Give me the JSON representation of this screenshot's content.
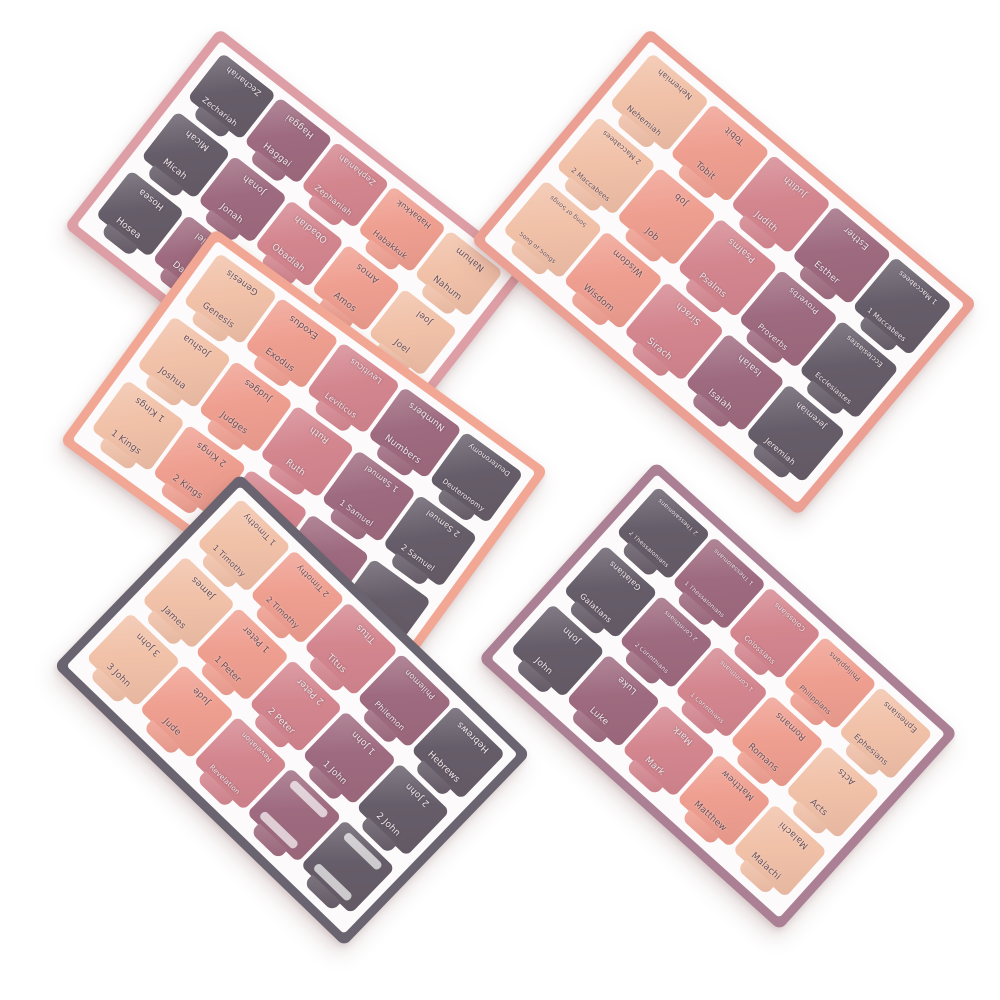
{
  "image_type": "product-photo",
  "subject": "Five sheets of Bible book index tab stickers scattered on a white background",
  "palette": {
    "page_bg": "#ffffff",
    "sheet_inner": "#fcfafa",
    "column_colors": [
      "#f1c1a8",
      "#ef9f90",
      "#d4868f",
      "#9e6a7f",
      "#655d69"
    ],
    "text_dark": "#6a4f57",
    "text_light": "#efe6ea"
  },
  "sheets": [
    {
      "id": "prophets",
      "border_color": "#dd9ea5",
      "geom": {
        "cx": 296,
        "cy": 248,
        "w": 392,
        "h": 252,
        "rot": 38,
        "z": 1
      },
      "column_color_order": [
        4,
        3,
        2,
        1,
        0
      ],
      "rows": [
        [
          "Zechariah",
          "Haggai",
          "Zephaniah",
          "Habakkuk",
          "Nahum"
        ],
        [
          "Micah",
          "Jonah",
          "Obadiah",
          "Amos",
          "Joel"
        ],
        [
          "Hosea",
          "Daniel",
          "",
          "",
          ""
        ]
      ],
      "blank_cells": []
    },
    {
      "id": "wisdom-books",
      "border_color": "#eba093",
      "geom": {
        "cx": 724,
        "cy": 272,
        "w": 428,
        "h": 278,
        "rot": 40,
        "z": 2
      },
      "column_color_order": [
        0,
        1,
        2,
        3,
        4
      ],
      "rows": [
        [
          "Nehemiah",
          "Tobit",
          "Judith",
          "Esther",
          "1 Maccabees"
        ],
        [
          "2 Maccabees",
          "Job",
          "Psalms",
          "Proverbs",
          "Ecclesiastes"
        ],
        [
          "Song of Songs",
          "Wisdom",
          "Sirach",
          "Isaiah",
          "Jeremiah"
        ]
      ],
      "blank_cells": []
    },
    {
      "id": "pentateuch-history",
      "border_color": "#f2a795",
      "geom": {
        "cx": 304,
        "cy": 456,
        "w": 412,
        "h": 264,
        "rot": 36,
        "z": 3
      },
      "column_color_order": [
        0,
        1,
        2,
        3,
        4
      ],
      "rows": [
        [
          "Genesis",
          "Exodus",
          "Leviticus",
          "Numbers",
          "Deuteronomy"
        ],
        [
          "Joshua",
          "Judges",
          "Ruth",
          "1 Samuel",
          "2 Samuel"
        ],
        [
          "1 Kings",
          "2 Kings",
          "",
          "",
          ""
        ]
      ],
      "blank_cells": []
    },
    {
      "id": "epistles-2",
      "border_color": "#6a6470",
      "geom": {
        "cx": 292,
        "cy": 710,
        "w": 404,
        "h": 268,
        "rot": 44,
        "z": 4
      },
      "column_color_order": [
        0,
        1,
        2,
        3,
        4
      ],
      "rows": [
        [
          "1 Timothy",
          "2 Timothy",
          "Titus",
          "Philemon",
          "Hebrews"
        ],
        [
          "James",
          "1 Peter",
          "2 Peter",
          "1 John",
          "2 John"
        ],
        [
          "3 John",
          "Jude",
          "Revelation",
          "",
          ""
        ]
      ],
      "blank_cells": [
        [
          2,
          3
        ],
        [
          2,
          4
        ]
      ]
    },
    {
      "id": "gospels-epistles-1",
      "border_color": "#ab8095",
      "geom": {
        "cx": 718,
        "cy": 696,
        "w": 406,
        "h": 266,
        "rot": 42,
        "z": 2
      },
      "column_color_order": [
        4,
        3,
        2,
        1,
        0
      ],
      "rows": [
        [
          "2 Thessalonians",
          "1 Thessalonians",
          "Colossians",
          "Philippians",
          "Ephesians"
        ],
        [
          "Galatians",
          "2 Corinthians",
          "1 Corinthians",
          "Romans",
          "Acts"
        ],
        [
          "John",
          "Luke",
          "Mark",
          "Matthew",
          "Malachi"
        ]
      ],
      "blank_cells": []
    }
  ]
}
